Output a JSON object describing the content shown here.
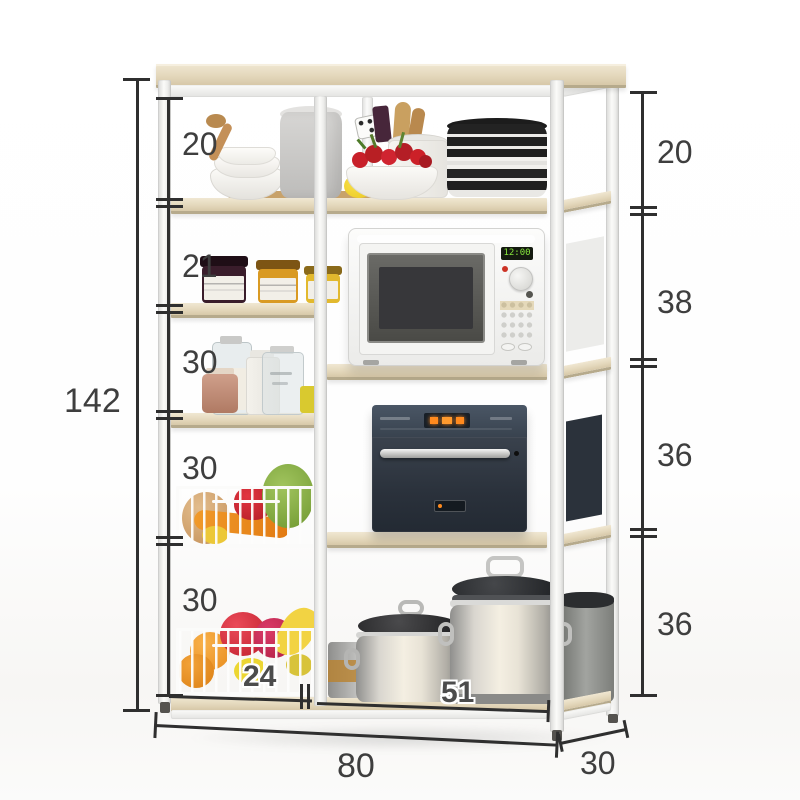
{
  "page": {
    "type": "product-dimension-diagram",
    "subject": "kitchen baker's rack shelf with microwave, steam oven, stock pots, wire produce baskets and jars"
  },
  "dimensions": {
    "overall_height": "142",
    "left_segments": [
      "20",
      "21",
      "30",
      "30",
      "30"
    ],
    "right_segments": [
      "20",
      "38",
      "36",
      "36"
    ],
    "overall_width": "80",
    "depth": "30",
    "left_section_width": "24",
    "right_section_width": "51"
  },
  "appliances": {
    "microwave_display": "12:00"
  },
  "colors": {
    "dimension_line": "#2f2f2f",
    "dimension_text": "#3e3e3e",
    "frame": "#f5f5f3",
    "wood": "#e4d8bc",
    "oven_panel": "#3e4855",
    "oven_display": "#ff8a1e",
    "microwave_display": "#86e63c",
    "jam_jar_dark": "#3a1d2b",
    "jam_jar_amber": "#d99a23",
    "basket_wire": "#fbfbfa"
  }
}
